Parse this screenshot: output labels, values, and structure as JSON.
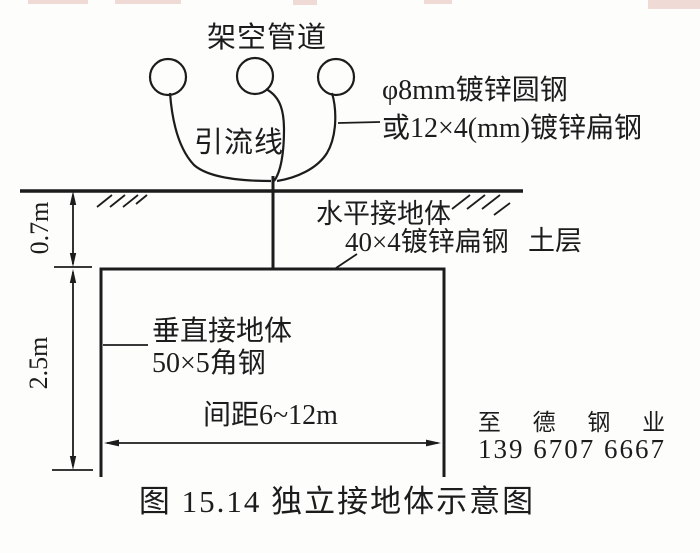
{
  "figure": {
    "caption": "图 15.14  独立接地体示意图",
    "labels": {
      "overhead_pipeline": "架空管道",
      "lead_wire": "引流线",
      "conductor_spec_line1": "φ8mm镀锌圆钢",
      "conductor_spec_line2": "或12×4(mm)镀锌扁钢",
      "horizontal_electrode": "水平接地体",
      "horizontal_electrode_spec": "40×4镀锌扁钢",
      "soil_layer": "土层",
      "vertical_electrode": "垂直接地体",
      "vertical_electrode_spec": "50×5角钢",
      "spacing": "间距6~12m",
      "burial_depth": "0.7m",
      "electrode_length": "2.5m"
    },
    "watermark": {
      "company": "至 德 钢 业",
      "phone": "139 6707 6667",
      "color": "#dfe5f8"
    },
    "colors": {
      "ink": "#1c1c1c",
      "background": "#fdfdfb"
    }
  }
}
